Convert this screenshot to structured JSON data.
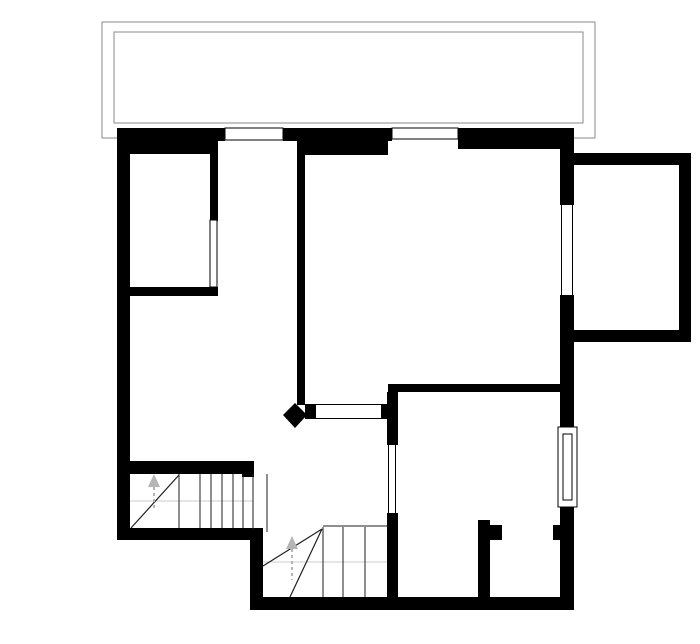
{
  "meta": {
    "type": "architectural-floor-plan",
    "width": 700,
    "height": 644
  },
  "colors": {
    "background": "#ffffff",
    "wall": "#000000",
    "terrace_outline": "#8a8a8a",
    "stair_line": "#1f1f1f",
    "walk_line": "#cccccc",
    "arrow": "#b5b5b5",
    "window_fill": "#ffffff",
    "window_frame": "#000000"
  },
  "plan": {
    "elements": [
      {
        "kind": "rect",
        "name": "terrace-outer-outline",
        "x": 102,
        "y": 22,
        "w": 493,
        "h": 116,
        "fill": "none",
        "stroke": "#8a8a8a",
        "sw": 1.3
      },
      {
        "kind": "rect",
        "name": "terrace-inner-outline",
        "x": 114,
        "y": 32,
        "w": 469,
        "h": 91,
        "fill": "#ffffff",
        "stroke": "#8a8a8a",
        "sw": 1.3
      },
      {
        "kind": "rect",
        "name": "wall-top-band-left",
        "x": 117,
        "y": 128,
        "w": 108,
        "h": 13,
        "fill": "#000000"
      },
      {
        "kind": "rect",
        "name": "wall-top-thick-left",
        "x": 117,
        "y": 141,
        "w": 101,
        "h": 13,
        "fill": "#000000"
      },
      {
        "kind": "rect",
        "name": "wall-top-band-middle",
        "x": 283,
        "y": 128,
        "w": 109,
        "h": 13,
        "fill": "#000000"
      },
      {
        "kind": "rect",
        "name": "wall-top-thick-middle",
        "x": 302,
        "y": 140,
        "w": 86,
        "h": 15,
        "fill": "#000000"
      },
      {
        "kind": "rect",
        "name": "wall-top-right",
        "x": 458,
        "y": 128,
        "w": 116,
        "h": 21,
        "fill": "#000000"
      },
      {
        "kind": "rect",
        "name": "wall-left-exterior",
        "x": 117,
        "y": 128,
        "w": 13,
        "h": 412,
        "fill": "#000000"
      },
      {
        "kind": "rect",
        "name": "wall-room1-right",
        "x": 210,
        "y": 141,
        "w": 8,
        "h": 80,
        "fill": "#000000"
      },
      {
        "kind": "rect",
        "name": "wall-room1-bottom",
        "x": 129,
        "y": 287,
        "w": 89,
        "h": 9,
        "fill": "#000000"
      },
      {
        "kind": "rect",
        "name": "wall-hall-partition",
        "x": 297,
        "y": 140,
        "w": 8,
        "h": 265,
        "fill": "#000000"
      },
      {
        "kind": "rect",
        "name": "wall-right-upper",
        "x": 560,
        "y": 128,
        "w": 14,
        "h": 77,
        "fill": "#000000"
      },
      {
        "kind": "rect",
        "name": "wall-right-middle",
        "x": 560,
        "y": 295,
        "w": 14,
        "h": 132,
        "fill": "#000000"
      },
      {
        "kind": "rect",
        "name": "wall-right-lower",
        "x": 560,
        "y": 507,
        "w": 14,
        "h": 103,
        "fill": "#000000"
      },
      {
        "kind": "rect",
        "name": "wall-right-doorstop",
        "x": 553,
        "y": 525,
        "w": 8,
        "h": 15,
        "fill": "#000000"
      },
      {
        "kind": "rect",
        "name": "wall-room2-top",
        "x": 388,
        "y": 384,
        "w": 172,
        "h": 8,
        "fill": "#000000"
      },
      {
        "kind": "rect",
        "name": "wall-room2-left-upper",
        "x": 387,
        "y": 392,
        "w": 11,
        "h": 53,
        "fill": "#000000"
      },
      {
        "kind": "rect",
        "name": "wall-room2-left-lower",
        "x": 387,
        "y": 513,
        "w": 11,
        "h": 85,
        "fill": "#000000"
      },
      {
        "kind": "rect",
        "name": "wall-room2-stub",
        "x": 478,
        "y": 520,
        "w": 12,
        "h": 78,
        "fill": "#000000"
      },
      {
        "kind": "rect",
        "name": "wall-room2-stub-notch",
        "x": 490,
        "y": 525,
        "w": 12,
        "h": 15,
        "fill": "#000000"
      },
      {
        "kind": "rect",
        "name": "wall-stair1-top",
        "x": 128,
        "y": 461,
        "w": 126,
        "h": 13,
        "fill": "#000000"
      },
      {
        "kind": "rect",
        "name": "wall-stair1-top-end",
        "x": 242,
        "y": 461,
        "w": 12,
        "h": 16,
        "fill": "#000000"
      },
      {
        "kind": "rect",
        "name": "wall-bottom-left",
        "x": 117,
        "y": 528,
        "w": 146,
        "h": 12,
        "fill": "#000000"
      },
      {
        "kind": "rect",
        "name": "wall-step-vertical",
        "x": 250,
        "y": 540,
        "w": 13,
        "h": 58,
        "fill": "#000000"
      },
      {
        "kind": "rect",
        "name": "wall-bottom-exterior",
        "x": 250,
        "y": 597,
        "w": 324,
        "h": 13,
        "fill": "#000000"
      },
      {
        "kind": "rect",
        "name": "wall-extension-top",
        "x": 574,
        "y": 153,
        "w": 117,
        "h": 12,
        "fill": "#000000"
      },
      {
        "kind": "rect",
        "name": "wall-extension-right",
        "x": 679,
        "y": 153,
        "w": 12,
        "h": 189,
        "fill": "#000000"
      },
      {
        "kind": "rect",
        "name": "wall-extension-bottom",
        "x": 574,
        "y": 330,
        "w": 117,
        "h": 12,
        "fill": "#000000"
      },
      {
        "kind": "rect",
        "name": "hall-door-cap-left",
        "x": 305,
        "y": 404,
        "w": 11,
        "h": 15,
        "fill": "#000000"
      },
      {
        "kind": "rect",
        "name": "hall-door-cap-right",
        "x": 381,
        "y": 404,
        "w": 7,
        "h": 15,
        "fill": "#000000"
      },
      {
        "kind": "polygon",
        "name": "wall-end-diamond",
        "points": "283,415 295,403 307,415 295,428",
        "fill": "#000000"
      },
      {
        "kind": "rect",
        "name": "window-top-1",
        "x": 225,
        "y": 128,
        "w": 58,
        "h": 12,
        "fill": "#ffffff",
        "stroke": "#000000",
        "sw": 1
      },
      {
        "kind": "rect",
        "name": "window-top-2",
        "x": 392,
        "y": 128,
        "w": 66,
        "h": 11,
        "fill": "#ffffff",
        "stroke": "#000000",
        "sw": 1
      },
      {
        "kind": "line",
        "name": "window-right-upper-l",
        "x1": 561.5,
        "y1": 205,
        "x2": 561.5,
        "y2": 295,
        "stroke": "#000000",
        "sw": 1
      },
      {
        "kind": "line",
        "name": "window-right-upper-r",
        "x1": 572.5,
        "y1": 205,
        "x2": 572.5,
        "y2": 295,
        "stroke": "#000000",
        "sw": 1
      },
      {
        "kind": "rect",
        "name": "window-right-lower-frame",
        "x": 558,
        "y": 427,
        "w": 19,
        "h": 80,
        "fill": "#ffffff",
        "stroke": "#000000",
        "sw": 1
      },
      {
        "kind": "rect",
        "name": "window-right-lower-glass",
        "x": 563,
        "y": 434,
        "w": 9,
        "h": 66,
        "fill": "none",
        "stroke": "#000000",
        "sw": 1
      },
      {
        "kind": "rect",
        "name": "glass-room1-panel",
        "x": 210,
        "y": 220,
        "w": 7,
        "h": 67,
        "fill": "#ffffff",
        "stroke": "#000000",
        "sw": 1
      },
      {
        "kind": "line",
        "name": "door-room2-line-l",
        "x1": 388.5,
        "y1": 445,
        "x2": 388.5,
        "y2": 513,
        "stroke": "#000000",
        "sw": 1
      },
      {
        "kind": "line",
        "name": "door-room2-line-r",
        "x1": 395.5,
        "y1": 445,
        "x2": 395.5,
        "y2": 513,
        "stroke": "#000000",
        "sw": 1
      },
      {
        "kind": "line",
        "name": "hall-door-line-top",
        "x1": 305,
        "y1": 404.5,
        "x2": 388,
        "y2": 404.5,
        "stroke": "#000000",
        "sw": 1
      },
      {
        "kind": "line",
        "name": "hall-door-line-bottom",
        "x1": 305,
        "y1": 418.5,
        "x2": 388,
        "y2": 418.5,
        "stroke": "#000000",
        "sw": 1
      },
      {
        "kind": "line",
        "name": "stair1-walk-line",
        "x1": 130,
        "y1": 501,
        "x2": 253,
        "y2": 501,
        "stroke": "#cccccc",
        "sw": 1
      },
      {
        "kind": "line",
        "name": "stair1-tread",
        "x1": 179,
        "y1": 474,
        "x2": 179,
        "y2": 528,
        "stroke": "#1f1f1f",
        "sw": 1
      },
      {
        "kind": "line",
        "name": "stair1-tread",
        "x1": 200,
        "y1": 474,
        "x2": 200,
        "y2": 528,
        "stroke": "#1f1f1f",
        "sw": 1
      },
      {
        "kind": "line",
        "name": "stair1-tread",
        "x1": 211,
        "y1": 474,
        "x2": 211,
        "y2": 528,
        "stroke": "#1f1f1f",
        "sw": 1
      },
      {
        "kind": "line",
        "name": "stair1-tread",
        "x1": 222,
        "y1": 474,
        "x2": 222,
        "y2": 528,
        "stroke": "#1f1f1f",
        "sw": 1
      },
      {
        "kind": "line",
        "name": "stair1-tread",
        "x1": 233,
        "y1": 474,
        "x2": 233,
        "y2": 528,
        "stroke": "#1f1f1f",
        "sw": 1
      },
      {
        "kind": "line",
        "name": "stair1-tread",
        "x1": 243,
        "y1": 474,
        "x2": 243,
        "y2": 528,
        "stroke": "#1f1f1f",
        "sw": 1
      },
      {
        "kind": "line",
        "name": "stair1-edge",
        "x1": 253,
        "y1": 474,
        "x2": 253,
        "y2": 530,
        "stroke": "#1f1f1f",
        "sw": 1
      },
      {
        "kind": "line",
        "name": "stair1-edge",
        "x1": 267,
        "y1": 474,
        "x2": 267,
        "y2": 532,
        "stroke": "#1f1f1f",
        "sw": 1
      },
      {
        "kind": "line",
        "name": "stair1-winder-diagonal",
        "x1": 131,
        "y1": 528,
        "x2": 179,
        "y2": 475,
        "stroke": "#1f1f1f",
        "sw": 1.2
      },
      {
        "kind": "line",
        "name": "stair2-walk-line",
        "x1": 263,
        "y1": 562,
        "x2": 387,
        "y2": 562,
        "stroke": "#cccccc",
        "sw": 1
      },
      {
        "kind": "line",
        "name": "stair2-landing-edge",
        "x1": 323,
        "y1": 526,
        "x2": 388,
        "y2": 526,
        "stroke": "#1f1f1f",
        "sw": 1
      },
      {
        "kind": "line",
        "name": "stair2-tread",
        "x1": 323,
        "y1": 527,
        "x2": 323,
        "y2": 597,
        "stroke": "#1f1f1f",
        "sw": 1
      },
      {
        "kind": "line",
        "name": "stair2-tread",
        "x1": 343,
        "y1": 527,
        "x2": 343,
        "y2": 597,
        "stroke": "#1f1f1f",
        "sw": 1
      },
      {
        "kind": "line",
        "name": "stair2-tread",
        "x1": 365,
        "y1": 527,
        "x2": 365,
        "y2": 597,
        "stroke": "#1f1f1f",
        "sw": 1
      },
      {
        "kind": "line",
        "name": "stair2-winder-diagonal",
        "x1": 322,
        "y1": 529,
        "x2": 263,
        "y2": 566,
        "stroke": "#1f1f1f",
        "sw": 1.2
      },
      {
        "kind": "line",
        "name": "stair2-winder-diagonal",
        "x1": 322,
        "y1": 529,
        "x2": 290,
        "y2": 597,
        "stroke": "#1f1f1f",
        "sw": 1.2
      },
      {
        "kind": "polygon",
        "name": "stair1-direction-arrowhead",
        "points": "148,487 154,474 160,487",
        "fill": "#b5b5b5"
      },
      {
        "kind": "line",
        "name": "stair1-direction-stem",
        "x1": 154,
        "y1": 487,
        "x2": 154,
        "y2": 509,
        "stroke": "#b5b5b5",
        "sw": 2,
        "dash": "3 3"
      },
      {
        "kind": "polygon",
        "name": "stair2-direction-arrowhead",
        "points": "286,549 292,536 298,549",
        "fill": "#b5b5b5"
      },
      {
        "kind": "line",
        "name": "stair2-direction-stem",
        "x1": 292,
        "y1": 549,
        "x2": 292,
        "y2": 580,
        "stroke": "#b5b5b5",
        "sw": 2,
        "dash": "3 3"
      }
    ]
  }
}
